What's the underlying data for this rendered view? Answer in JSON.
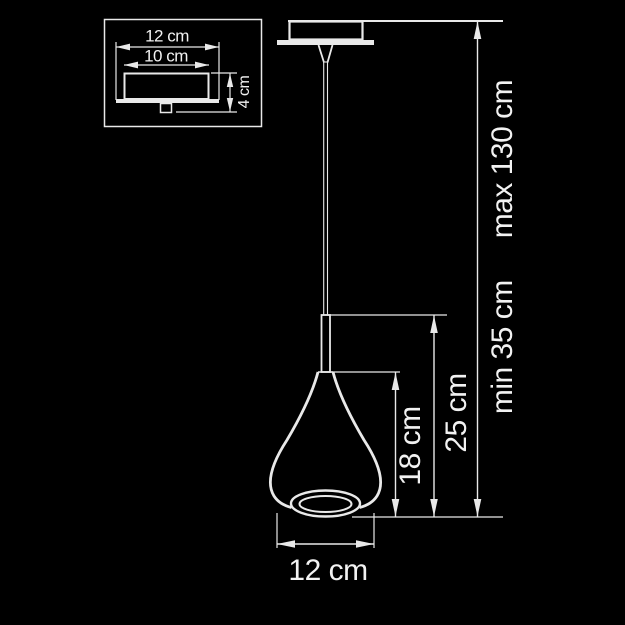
{
  "colors": {
    "background": "#000000",
    "line": "#e9e9e9",
    "text": "#f2f2f2"
  },
  "inset": {
    "flange_width": "12 cm",
    "body_width": "10 cm",
    "height": "4 cm"
  },
  "main": {
    "shade_height": "18 cm",
    "fixture_height": "25 cm",
    "suspension_min": "min 35 cm",
    "suspension_max": "max 130 cm",
    "shade_diameter": "12 cm"
  }
}
